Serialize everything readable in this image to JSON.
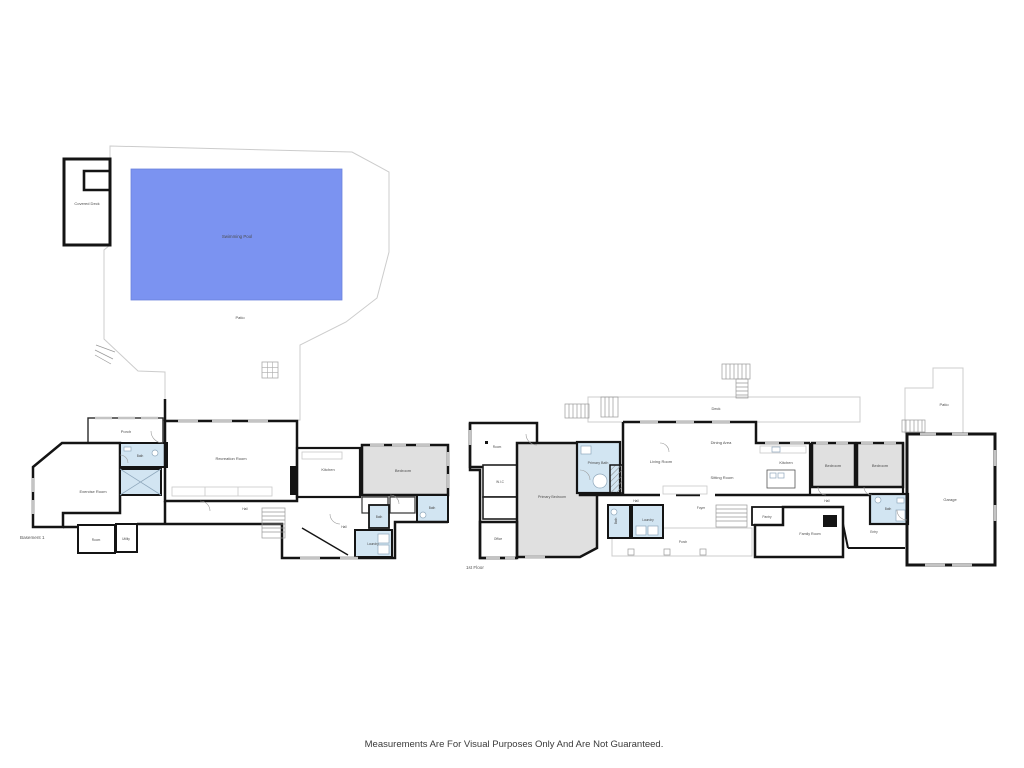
{
  "pool_area": {
    "covered_deck": "Covered Deck",
    "swimming_pool": "Swimming Pool",
    "patio": "Patio"
  },
  "basement": {
    "caption": "Basement 1",
    "rooms": {
      "porch": "Porch",
      "bath": "Bath",
      "exercise_room": "Exercise Room",
      "recreation_room": "Recreation Room",
      "kitchen": "Kitchen",
      "bedroom": "Bedroom",
      "bath2": "Bath",
      "hall": "Hall",
      "hall2": "Hall",
      "bath3": "Bath",
      "laundry": "Laundry",
      "room": "Room",
      "utility": "Utility"
    }
  },
  "first_floor": {
    "caption": "1st Floor",
    "rooms": {
      "room": "Room",
      "wic": "W.I.C",
      "primary_bedroom": "Primary Bedroom",
      "primary_bath": "Primary Bath",
      "office": "Office",
      "living_room": "Living Room",
      "dining_area": "Dining Area",
      "sitting_room": "Sitting Room",
      "kitchen": "Kitchen",
      "deck": "Deck",
      "patio": "Patio",
      "bedroom1": "Bedroom",
      "bedroom2": "Bedroom",
      "garage": "Garage",
      "pantry": "Pantry",
      "hall": "Hall",
      "hall2": "Hall",
      "bath": "Bath",
      "bath2": "Bath",
      "laundry": "Laundry",
      "foyer": "Foyer",
      "porch": "Porch",
      "family_room": "Family Room",
      "entry": "Entry"
    }
  },
  "footer": {
    "disclaimer": "Measurements Are For Visual Purposes Only And Are Not Guaranteed."
  },
  "colors": {
    "pool": "#7b93f1",
    "pool_stroke": "#6c83dd",
    "pool_text": "#2433b8",
    "bath": "#d2e5f2",
    "bedroom": "#e0e0e0",
    "wall": "#141414"
  }
}
